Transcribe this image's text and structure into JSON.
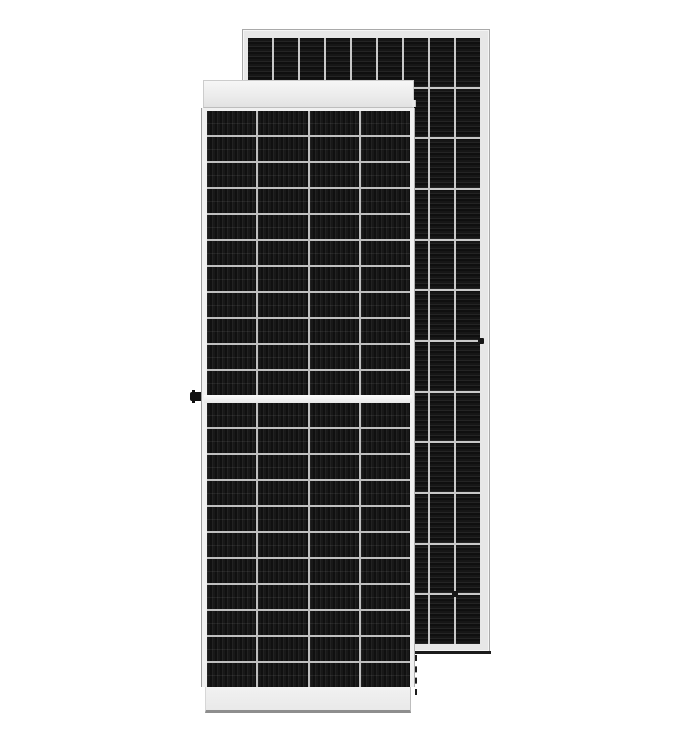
{
  "scene": {
    "description": "Product render of two framed dark monocrystalline solar panels on a white background; a shorter front-view panel overlaps a taller panel standing behind it to the right",
    "background_color": "#ffffff"
  },
  "front_panel": {
    "label": "front solar panel, front view with half-cut cell layout",
    "grid_top": {
      "columns": 4,
      "rows": 11,
      "cell_name": "front-solar-cell"
    },
    "grid_bottom": {
      "columns": 4,
      "rows": 11,
      "cell_name": "front-solar-cell"
    },
    "frame_color": "#f0f0f0",
    "divider_color": "#bfbfbf",
    "cell_dark": "#101010",
    "cell_stripe": "#222222",
    "features": [
      "white top frame rail",
      "white center rail between cell halves",
      "white bottom frame pedestal",
      "black grounding lug on left frame"
    ]
  },
  "back_panel": {
    "label": "taller solar panel standing behind, horizontal cell striping",
    "grid": {
      "columns": 9,
      "rows": 12,
      "cell_name": "back-solar-cell"
    },
    "frame_color": "#e7e7e7",
    "divider_color": "#c8c8c8",
    "cell_dark": "#0f0f0f",
    "cell_stripe": "#242424",
    "shadow_color": "#1b1b1b",
    "features": [
      "thin light-gray frame",
      "dark ground shadow line under bottom edge",
      "small dark frame holes",
      "dashed hidden-edge line below overlap"
    ]
  },
  "details": {
    "grounding_lug_color": "#111111",
    "hidden_edge_style": "dashed"
  }
}
